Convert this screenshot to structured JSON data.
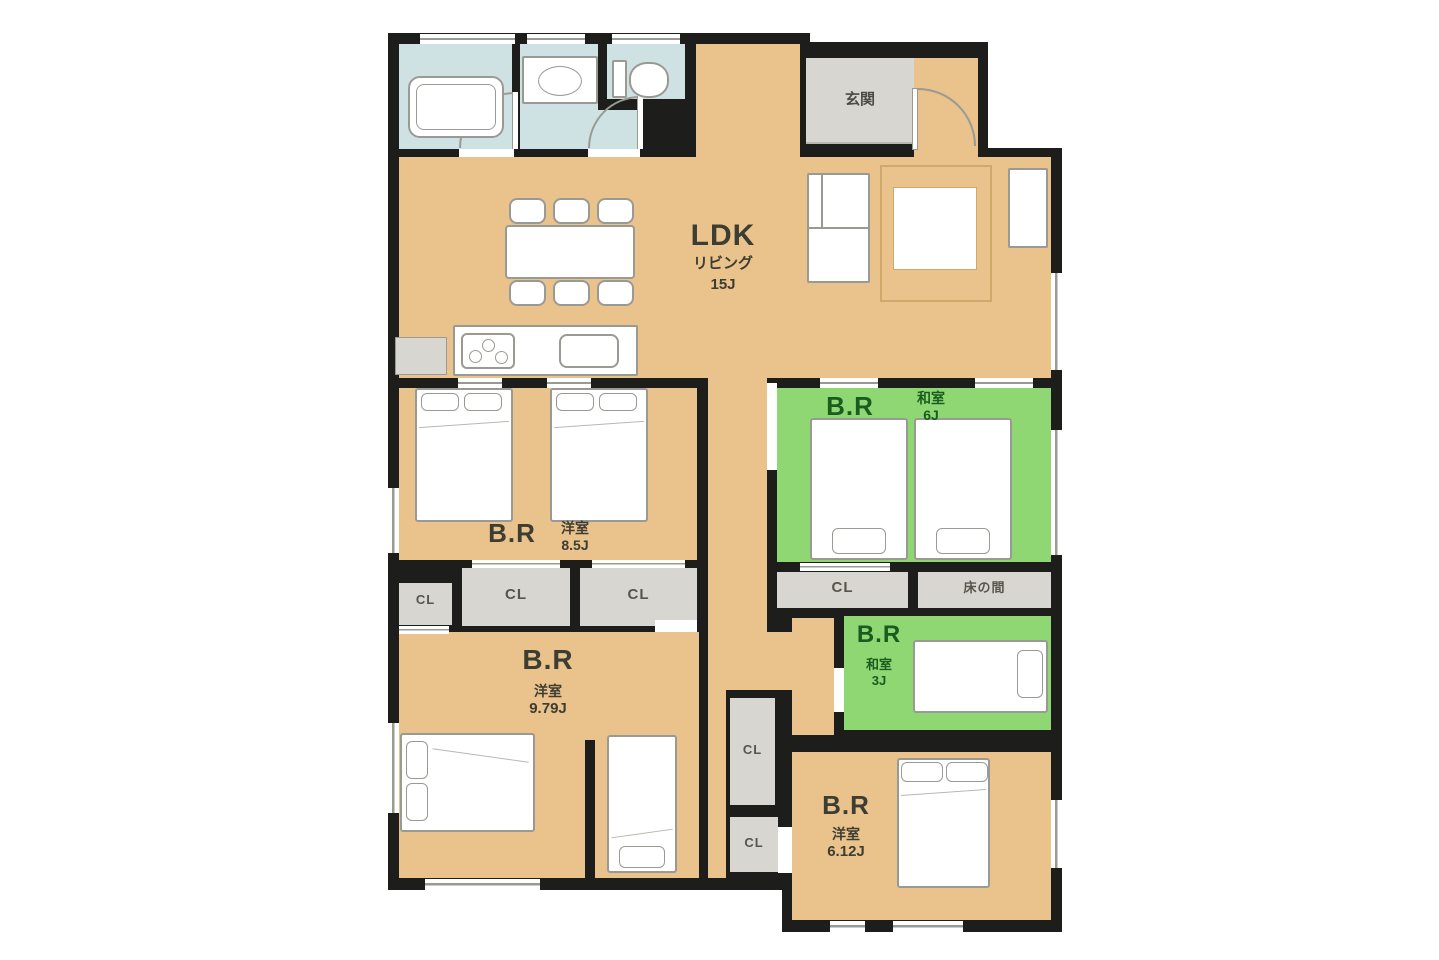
{
  "colors": {
    "wall": "#1d1d1b",
    "floor": "#eac28b",
    "tatami": "#8fd773",
    "wet": "#cfe2e3",
    "closet": "#d8d6d0",
    "stroke": "#9a9a94",
    "text_dark": "#3c3d33",
    "text_green": "#1a5c1f",
    "rug_line": "#cfa86b"
  },
  "rooms": [
    {
      "name": "LDK",
      "sub": "リビング",
      "size": "15J"
    },
    {
      "name": "玄関"
    },
    {
      "name": "B.R",
      "sub": "和室",
      "size": "6J"
    },
    {
      "name": "B.R",
      "sub": "洋室",
      "size": "8.5J"
    },
    {
      "name": "B.R",
      "sub": "洋室",
      "size": "9.79J"
    },
    {
      "name": "B.R",
      "sub": "和室",
      "size": "3J"
    },
    {
      "name": "B.R",
      "sub": "洋室",
      "size": "6.12J"
    }
  ],
  "features": {
    "closet": "CL",
    "tokonoma": "床の間"
  },
  "fixtures": [
    "bathtub",
    "washbasin",
    "toilet",
    "dining-table",
    "chair",
    "kitchen-stove",
    "kitchen-sink",
    "refrigerator",
    "low-table",
    "cabinet",
    "double-bed",
    "single-bed"
  ]
}
